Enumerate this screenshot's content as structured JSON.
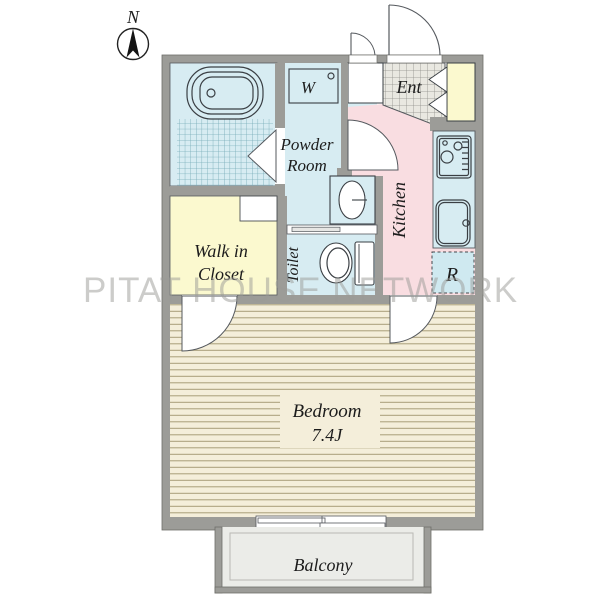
{
  "compass": {
    "label": "N"
  },
  "watermark": "PITAT HOUSE NETWORK",
  "rooms": {
    "powder_room": {
      "line1": "Powder",
      "line2": "Room"
    },
    "washer": "W",
    "entrance": "Ent",
    "kitchen": "Kitchen",
    "refrigerator": "R",
    "walk_in_closet": {
      "line1": "Walk in",
      "line2": "Closet"
    },
    "toilet": "Toilet",
    "bedroom": {
      "name": "Bedroom",
      "size": "7.4J"
    },
    "balcony": "Balcony"
  },
  "colors": {
    "wet_area": "#d7ecf2",
    "closet": "#fbf9cf",
    "kitchen": "#f9dde1",
    "flooring": "#f4eeda",
    "entrance_tile": "#e9e8e1",
    "wall": "#9c9c98",
    "balcony_floor": "#ebece8"
  }
}
